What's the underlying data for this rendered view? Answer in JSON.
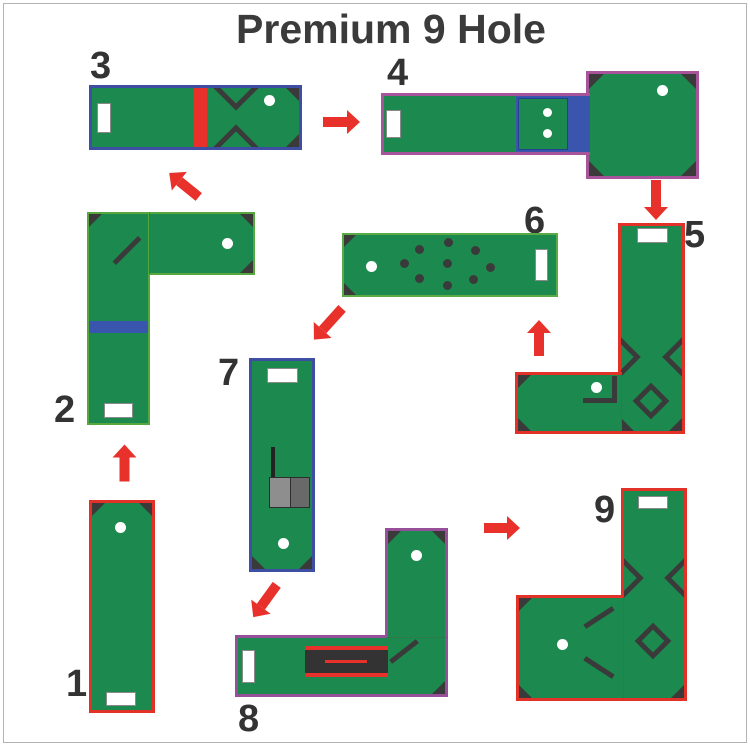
{
  "title": "Premium 9 Hole",
  "holes": [
    {
      "label": "1",
      "border_color": "#e23228",
      "obstacles": [
        "tee-pad",
        "cup"
      ]
    },
    {
      "label": "2",
      "border_color": "#56a83e",
      "obstacles": [
        "tee-pad",
        "cup",
        "diagonal-wall",
        "blue-speed-bump"
      ]
    },
    {
      "label": "3",
      "border_color": "#3e4fa3",
      "obstacles": [
        "tee-pad",
        "cup",
        "red-speed-bump",
        "chevron-gate"
      ]
    },
    {
      "label": "4",
      "border_color": "#a8549a",
      "obstacles": [
        "tee-pad",
        "cup",
        "blue-bridge",
        "double-dot-ramp"
      ]
    },
    {
      "label": "5",
      "border_color": "#e23228",
      "obstacles": [
        "tee-pad",
        "cup",
        "edge-chevrons",
        "diamond-block",
        "corner-wall"
      ]
    },
    {
      "label": "6",
      "border_color": "#5aaa46",
      "obstacles": [
        "tee-pad",
        "cup",
        "nine-bump-field"
      ]
    },
    {
      "label": "7",
      "border_color": "#3e4fa3",
      "obstacles": [
        "tee-pad",
        "cup",
        "grey-ramp",
        "guide-wall"
      ]
    },
    {
      "label": "8",
      "border_color": "#96509a",
      "obstacles": [
        "tee-pad",
        "cup",
        "tunnel-ramp",
        "diagonal-wall"
      ]
    },
    {
      "label": "9",
      "border_color": "#e23228",
      "obstacles": [
        "tee-pad",
        "cup",
        "edge-chevrons",
        "diamond-block",
        "diagonal-walls"
      ]
    }
  ],
  "flow_arrows": [
    {
      "from": 1,
      "to": 2,
      "direction": "up"
    },
    {
      "from": 2,
      "to": 3,
      "direction": "up-left"
    },
    {
      "from": 3,
      "to": 4,
      "direction": "right"
    },
    {
      "from": 4,
      "to": 5,
      "direction": "down"
    },
    {
      "from": 5,
      "to": 6,
      "direction": "up"
    },
    {
      "from": 6,
      "to": 7,
      "direction": "down-left"
    },
    {
      "from": 7,
      "to": 8,
      "direction": "down-left"
    },
    {
      "from": 8,
      "to": 9,
      "direction": "right"
    }
  ],
  "colors": {
    "felt_green": "#1c8a4e",
    "obstacle_dark": "#3a3a3a",
    "arrow_red": "#e8312a",
    "bumper_blue": "#3a55ae",
    "ramp_grey": "#8e8e8e",
    "cup_white": "#ffffff",
    "title_text": "#3b3b3b"
  }
}
